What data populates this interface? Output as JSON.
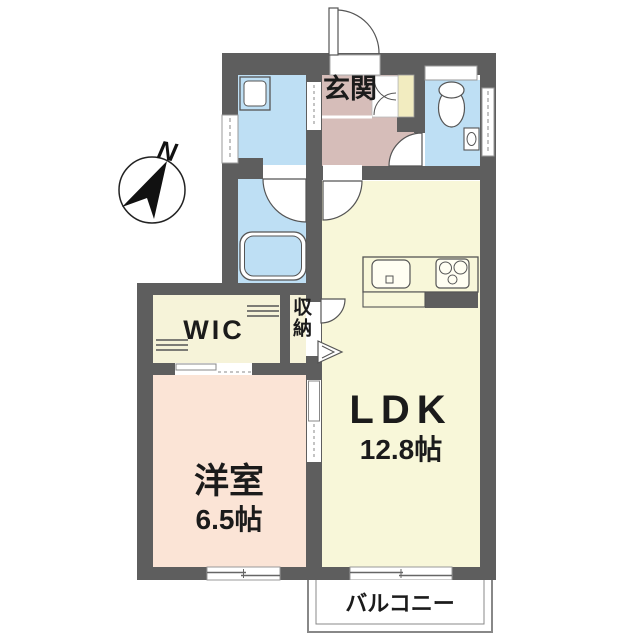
{
  "plan": {
    "compass": {
      "north_label": "N"
    },
    "rooms": {
      "entrance": {
        "label": "玄関"
      },
      "ldk": {
        "label": "LDK",
        "size": "12.8帖"
      },
      "western_room": {
        "label": "洋室",
        "size": "6.5帖"
      },
      "walk_in_closet": {
        "label": "WIC"
      },
      "storage": {
        "label": "収納"
      },
      "balcony": {
        "label": "バルコニー"
      }
    },
    "icons": [
      "washing-machine-pan",
      "bathtub",
      "toilet",
      "hand-wash-basin",
      "kitchen-sink",
      "gas-stove",
      "shoe-cabinet",
      "hanger-pole",
      "hinged-door-arc",
      "folding-door",
      "sliding-door",
      "sliding-window",
      "compass-needle"
    ],
    "colors": {
      "wall": "#5e5e5e",
      "ldk_floor": "#f8f7d9",
      "western_room_floor": "#fbe4d6",
      "entrance_floor": "#d6bdb9",
      "wet_area_floor": "#bedff4",
      "closet_floor": "#f6f3d9",
      "shoe_cabinet": "#f2ecc0",
      "text": "#1b1b1b"
    }
  }
}
